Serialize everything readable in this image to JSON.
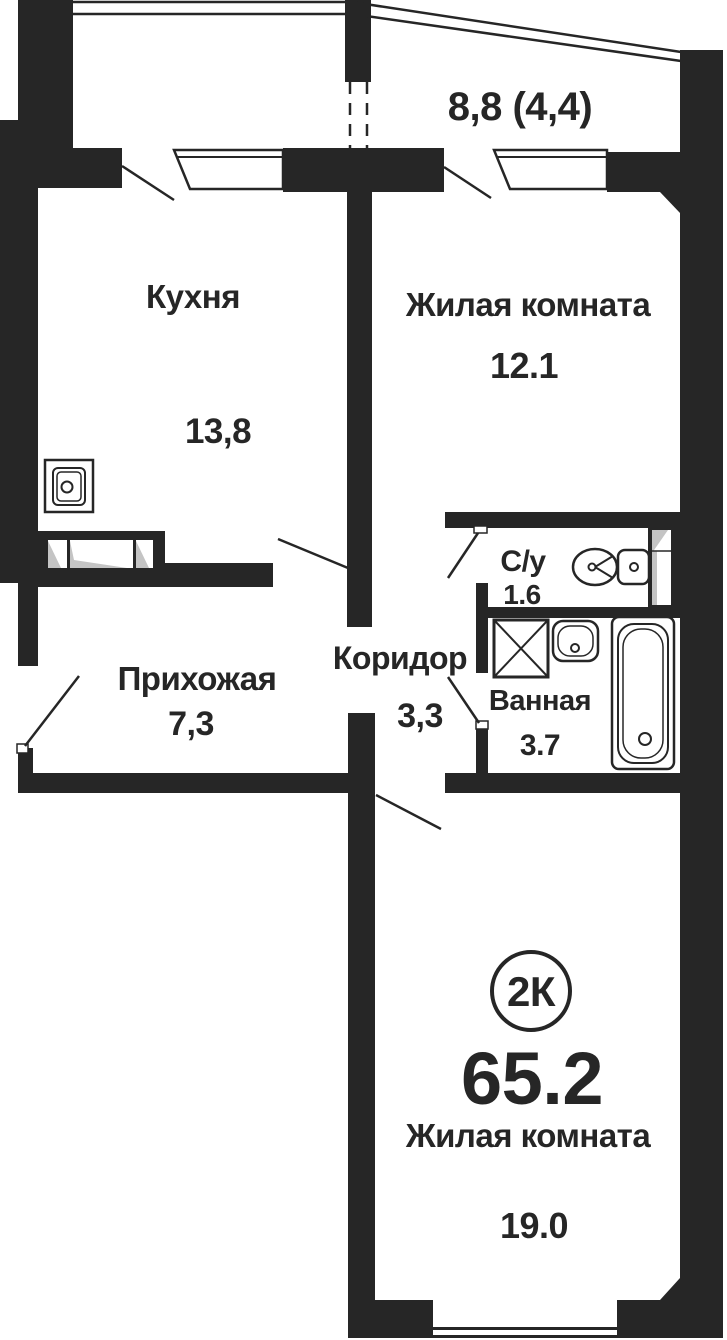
{
  "colors": {
    "wall": "#262626",
    "background": "#ffffff",
    "shade": "#c4c4c4"
  },
  "plan": {
    "badge": "2К",
    "total_area": "65.2",
    "balcony_area": "8,8 (4,4)",
    "rooms": {
      "kitchen": {
        "name": "Кухня",
        "area": "13,8"
      },
      "living1": {
        "name": "Жилая комната",
        "area": "12.1"
      },
      "wc": {
        "name": "С/у",
        "area": "1.6"
      },
      "bathroom": {
        "name": "Ванная",
        "area": "3.7"
      },
      "corridor": {
        "name": "Коридор",
        "area": "3,3"
      },
      "hallway": {
        "name": "Прихожая",
        "area": "7,3"
      },
      "living2": {
        "name": "Жилая комната",
        "area": "19.0"
      }
    },
    "icons": [
      "kitchen-sink-icon",
      "vent-duct-icon",
      "toilet-icon",
      "washing-machine-icon",
      "bathroom-sink-icon",
      "bathtub-icon",
      "shaft-icon"
    ]
  }
}
